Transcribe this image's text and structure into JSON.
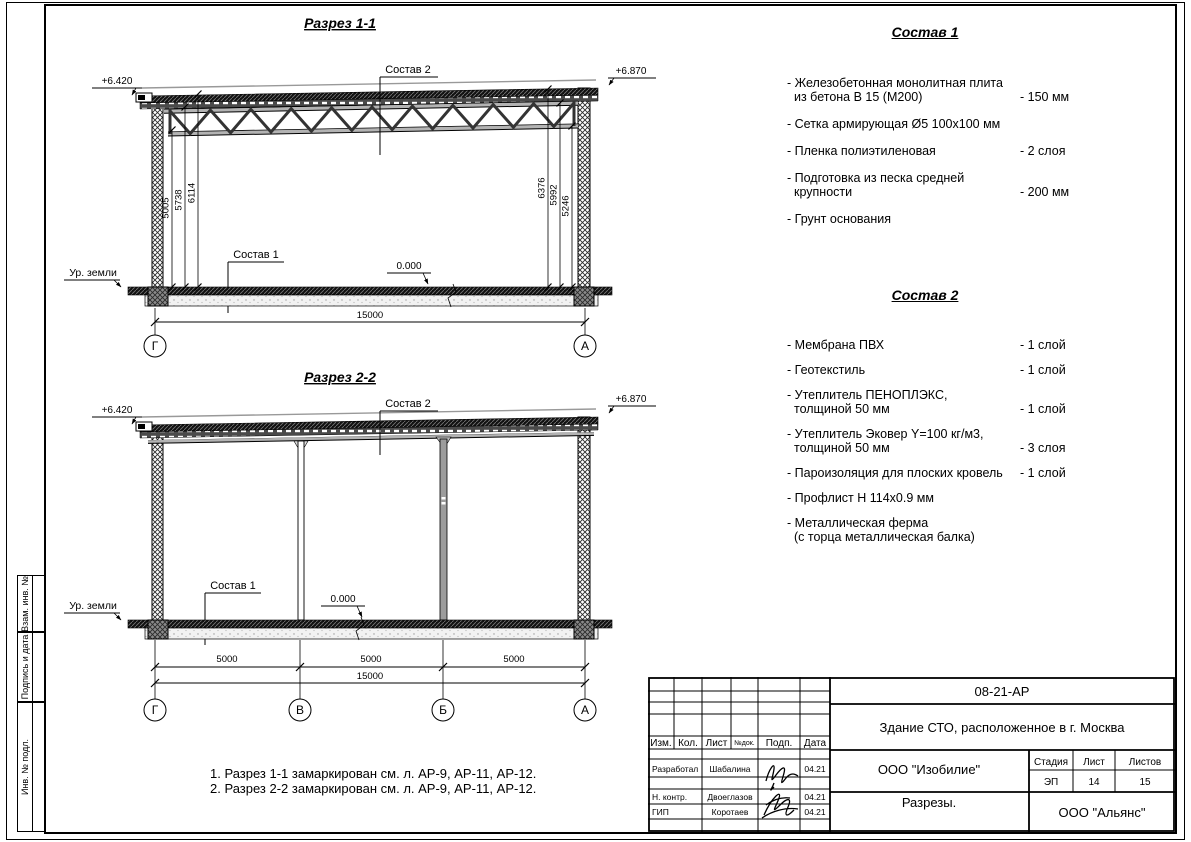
{
  "section1": {
    "title": "Разрез 1-1",
    "level_left": "+6.420",
    "level_right": "+6.870",
    "callout_roof": "Состав 2",
    "callout_floor": "Состав 1",
    "level_zero": "0.000",
    "ground": "Ур. земли",
    "dims_left": [
      "5005",
      "5738",
      "6114"
    ],
    "dims_right": [
      "6376",
      "5992",
      "5246"
    ],
    "dim_total": "15000",
    "axis_left": "Г",
    "axis_right": "А"
  },
  "section2": {
    "title": "Разрез 2-2",
    "level_left": "+6.420",
    "level_right": "+6.870",
    "callout_roof": "Состав 2",
    "callout_floor": "Состав 1",
    "level_zero": "0.000",
    "ground": "Ур. земли",
    "dims": [
      "5000",
      "5000",
      "5000"
    ],
    "dim_total": "15000",
    "axes": [
      "Г",
      "В",
      "Б",
      "А"
    ]
  },
  "sostav1": {
    "title": "Состав 1",
    "items": [
      {
        "l1": "- Железобетонная  монолитная плита",
        "l2": "из бетона В 15 (М200)",
        "value": "- 150 мм"
      },
      {
        "l1": "- Сетка армирующая Ø5 100х100 мм",
        "l2": "",
        "value": ""
      },
      {
        "l1": "- Пленка полиэтиленовая",
        "l2": "",
        "value": "-  2 слоя"
      },
      {
        "l1": "- Подготовка из песка средней",
        "l2": "крупности",
        "value": "- 200 мм"
      },
      {
        "l1": "- Грунт основания",
        "l2": "",
        "value": ""
      }
    ]
  },
  "sostav2": {
    "title": "Состав 2",
    "items": [
      {
        "l1": "- Мембрана ПВХ",
        "l2": "",
        "value": "- 1 слой"
      },
      {
        "l1": "- Геотекстиль",
        "l2": "",
        "value": "- 1 слой"
      },
      {
        "l1": "- Утеплитель ПЕНОПЛЭКС,",
        "l2": "толщиной 50 мм",
        "value": "- 1 слой"
      },
      {
        "l1": "- Утеплитель Эковер Y=100 кг/м3,",
        "l2": "толщиной 50 мм",
        "value": "- 3 слоя"
      },
      {
        "l1": "- Пароизоляция для плоских кровель",
        "l2": "",
        "value": "- 1 слой"
      },
      {
        "l1": "- Профлист Н 114х0.9 мм",
        "l2": "",
        "value": ""
      },
      {
        "l1": "- Металлическая ферма",
        "l2": "(с торца металлическая балка)",
        "value": ""
      }
    ]
  },
  "notes": {
    "line1": "1. Разрез 1-1 замаркирован см. л. АР-9, АР-11, АР-12.",
    "line2": "2. Разрез 2-2 замаркирован см. л. АР-9, АР-11, АР-12."
  },
  "stamp": {
    "doc_number": "08-21-АР",
    "object": "Здание СТО, расположенное в г. Москва",
    "cols": {
      "izm": "Изм.",
      "kol": "Кол.",
      "list": "Лист",
      "ndok": "№док.",
      "podp": "Подп.",
      "data": "Дата"
    },
    "rows": [
      {
        "role": "Разработал",
        "name": "Шабалина",
        "date": "04.21"
      },
      {
        "role": "Н. контр.",
        "name": "Двоеглазов",
        "date": "04.21"
      },
      {
        "role": "ГИП",
        "name": "Коротаев",
        "date": "04.21"
      }
    ],
    "company": "ООО \"Изобилие\"",
    "stage_label": "Стадия",
    "list_label": "Лист",
    "listov_label": "Листов",
    "stage": "ЭП",
    "sheet_no": "14",
    "sheets_total": "15",
    "drawing_title": "Разрезы.",
    "org": "ООО \"Альянс\""
  },
  "frame_labels": {
    "vzam": "Взам. инв. №",
    "podpis": "Подпись и дата",
    "inv": "Инв. № подл."
  },
  "colors": {
    "ink": "#000000",
    "paper": "#ffffff",
    "hatch_dark": "#111111",
    "steel_gray": "#9c9c9c"
  }
}
